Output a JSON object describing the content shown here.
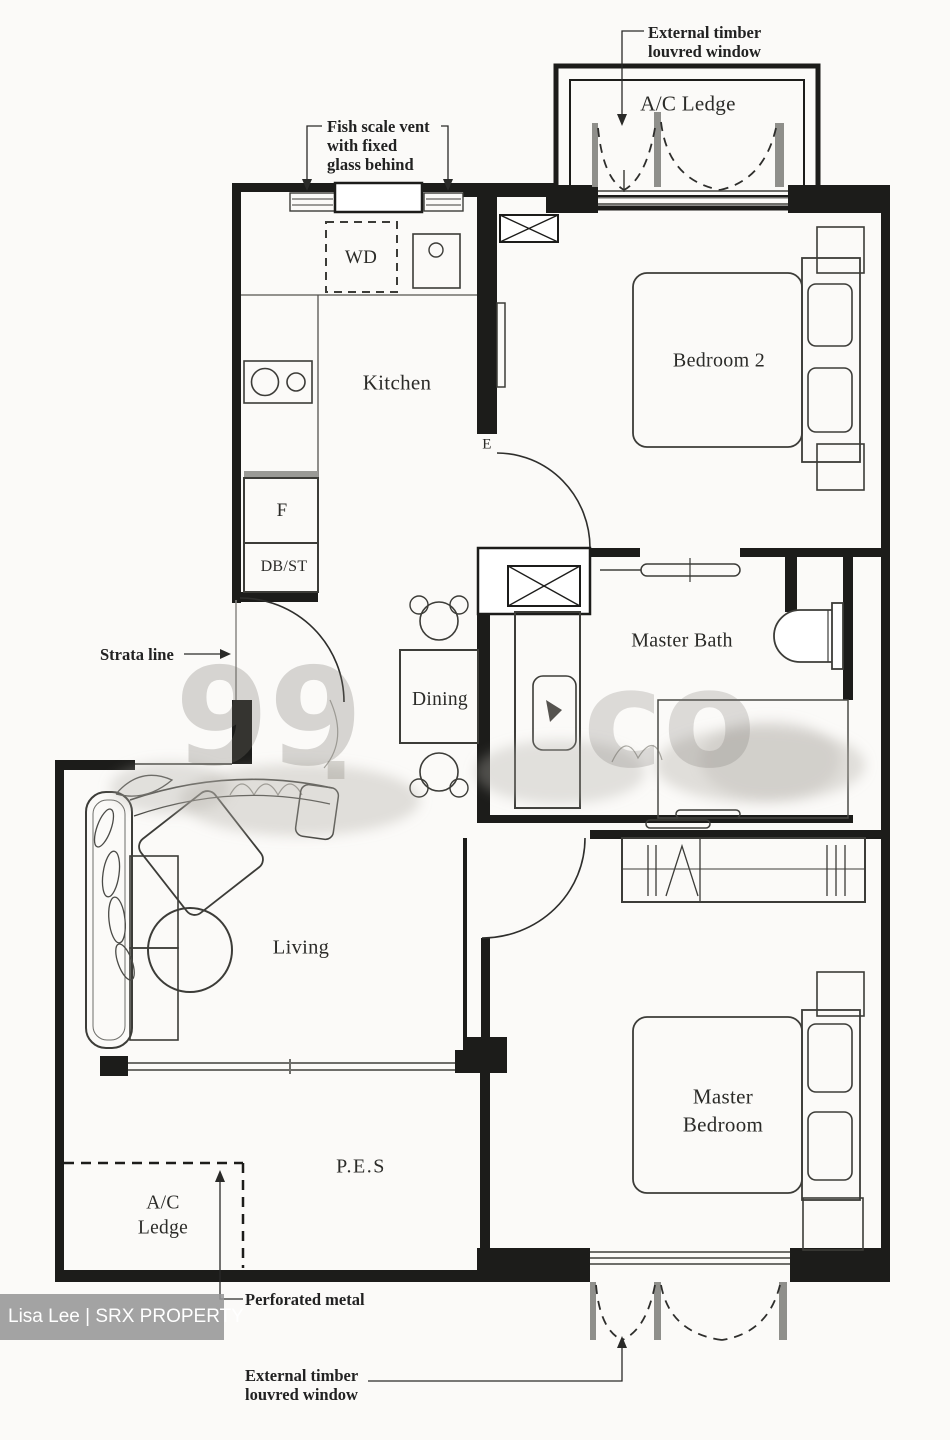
{
  "plan": {
    "rooms": {
      "ac_ledge_top": {
        "label": "A/C Ledge"
      },
      "kitchen": {
        "label": "Kitchen"
      },
      "bedroom2": {
        "label": "Bedroom 2"
      },
      "master_bath": {
        "label": "Master Bath"
      },
      "dining": {
        "label": "Dining"
      },
      "living": {
        "label": "Living"
      },
      "master_bedroom": {
        "label": "Master\nBedroom"
      },
      "pes": {
        "label": "P.E.S"
      },
      "ac_ledge_bottom": {
        "label": "A/C\nLedge"
      }
    },
    "fixtures": {
      "washer_dryer": "WD",
      "fridge": "F",
      "db_store": "DB/ST",
      "entrance": "E"
    },
    "annotations": {
      "louvred_window_top": "External timber\nlouvred window",
      "fish_scale_vent": "Fish scale vent\nwith fixed\nglass behind",
      "strata_line": "Strata line",
      "perforated_metal": "Perforated metal",
      "louvred_window_bottom": "External timber\nlouvred window"
    }
  },
  "watermarks": {
    "brand_left": "99",
    "brand_dot": ".",
    "brand_right": "co",
    "agent": "Lisa Lee | SRX PROPERTY"
  },
  "colors": {
    "ink": "#1c1c1a",
    "paper": "#fbfaf8",
    "watermark_gray": "#767264",
    "agent_bar": "#969696"
  }
}
